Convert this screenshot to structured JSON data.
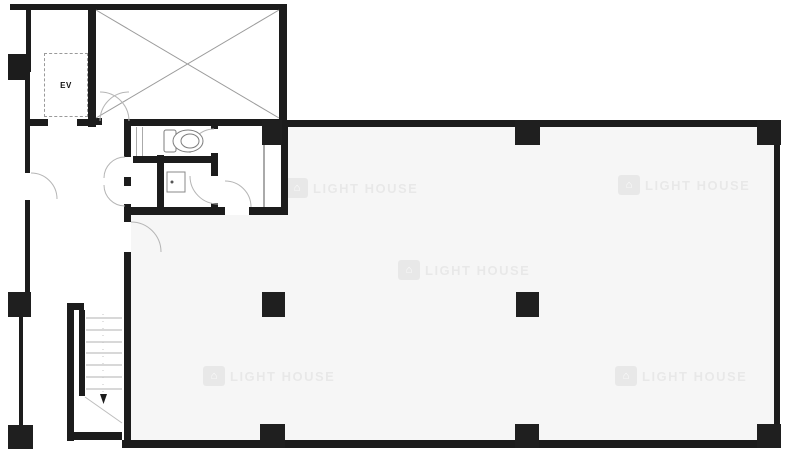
{
  "plan": {
    "labels": {
      "elevator": "EV"
    },
    "watermark": {
      "text": "LIGHT HOUSE",
      "occurrences": 5,
      "icon": "house-icon"
    },
    "stairs": {
      "tread_count": 7,
      "direction_arrow": "down"
    },
    "colors": {
      "wall": "#1c1c1c",
      "floor_fill": "#f6f6f6",
      "detail_line": "#999999",
      "watermark": "#ededed",
      "background": "#ffffff"
    },
    "icons": {
      "toilet": "toilet-fixture-icon",
      "sink": "sink-fixture-icon",
      "cross_bracing": "x-cross-shaft-icon",
      "down_arrow": "stair-down-arrow-icon"
    }
  }
}
